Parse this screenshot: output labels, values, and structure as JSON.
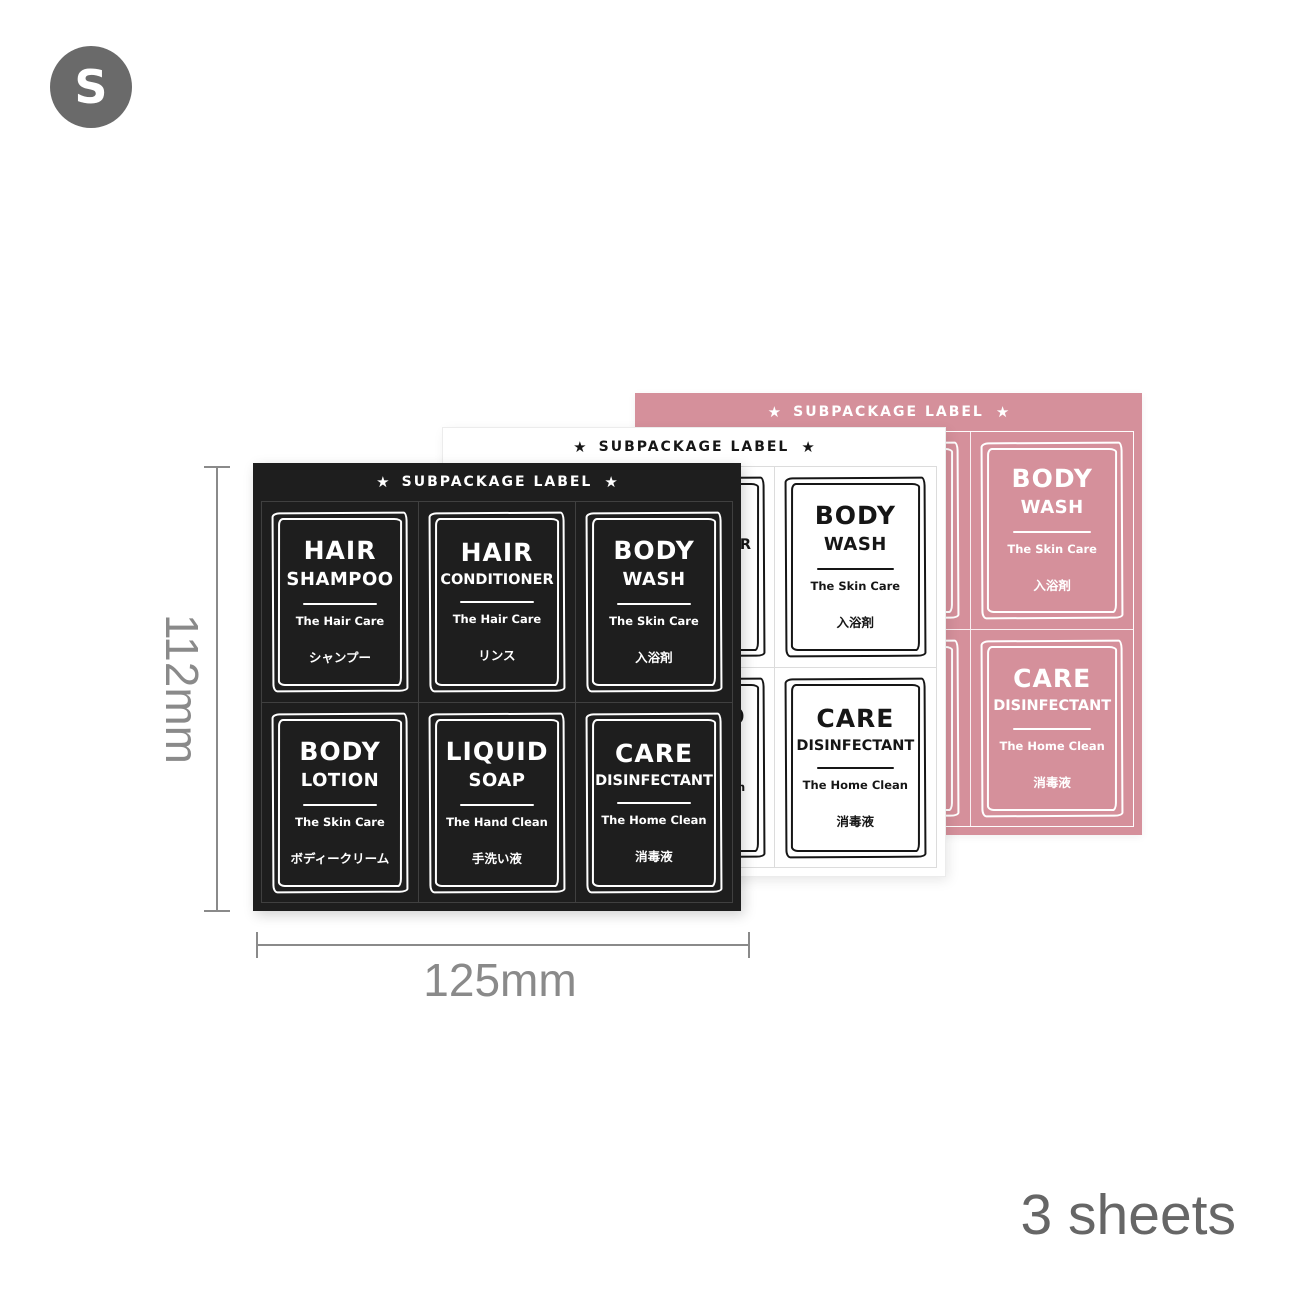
{
  "badge": {
    "letter": "S"
  },
  "sheets": {
    "header_label": "SUBPACKAGE LABEL",
    "star": "★",
    "variants": [
      "pink",
      "white",
      "black"
    ],
    "labels": [
      {
        "id": "hair-shampoo",
        "line1": "HAIR",
        "line2": "SHAMPOO",
        "sub": "The Hair Care",
        "jp": "シャンプー"
      },
      {
        "id": "hair-conditioner",
        "line1": "HAIR",
        "line2": "CONDITIONER",
        "sub": "The Hair Care",
        "jp": "リンス"
      },
      {
        "id": "body-wash",
        "line1": "BODY",
        "line2": "WASH",
        "sub": "The Skin Care",
        "jp": "入浴剤"
      },
      {
        "id": "body-lotion",
        "line1": "BODY",
        "line2": "LOTION",
        "sub": "The Skin Care",
        "jp": "ボディークリーム"
      },
      {
        "id": "liquid-soap",
        "line1": "LIQUID",
        "line2": "SOAP",
        "sub": "The Hand Clean",
        "jp": "手洗い液"
      },
      {
        "id": "care-disinfectant",
        "line1": "CARE",
        "line2": "DISINFECTANT",
        "sub": "The Home Clean",
        "jp": "消毒液"
      }
    ]
  },
  "dimensions": {
    "height": "112mm",
    "width": "125mm"
  },
  "captions": {
    "sheet_count": "3 sheets"
  },
  "colors": {
    "badge": "#6a6a6a",
    "black_sheet": "#1e1e1e",
    "white_sheet": "#ffffff",
    "pink_sheet": "#d5909b",
    "dimension": "#8a8a8a",
    "count_text": "#666666"
  }
}
